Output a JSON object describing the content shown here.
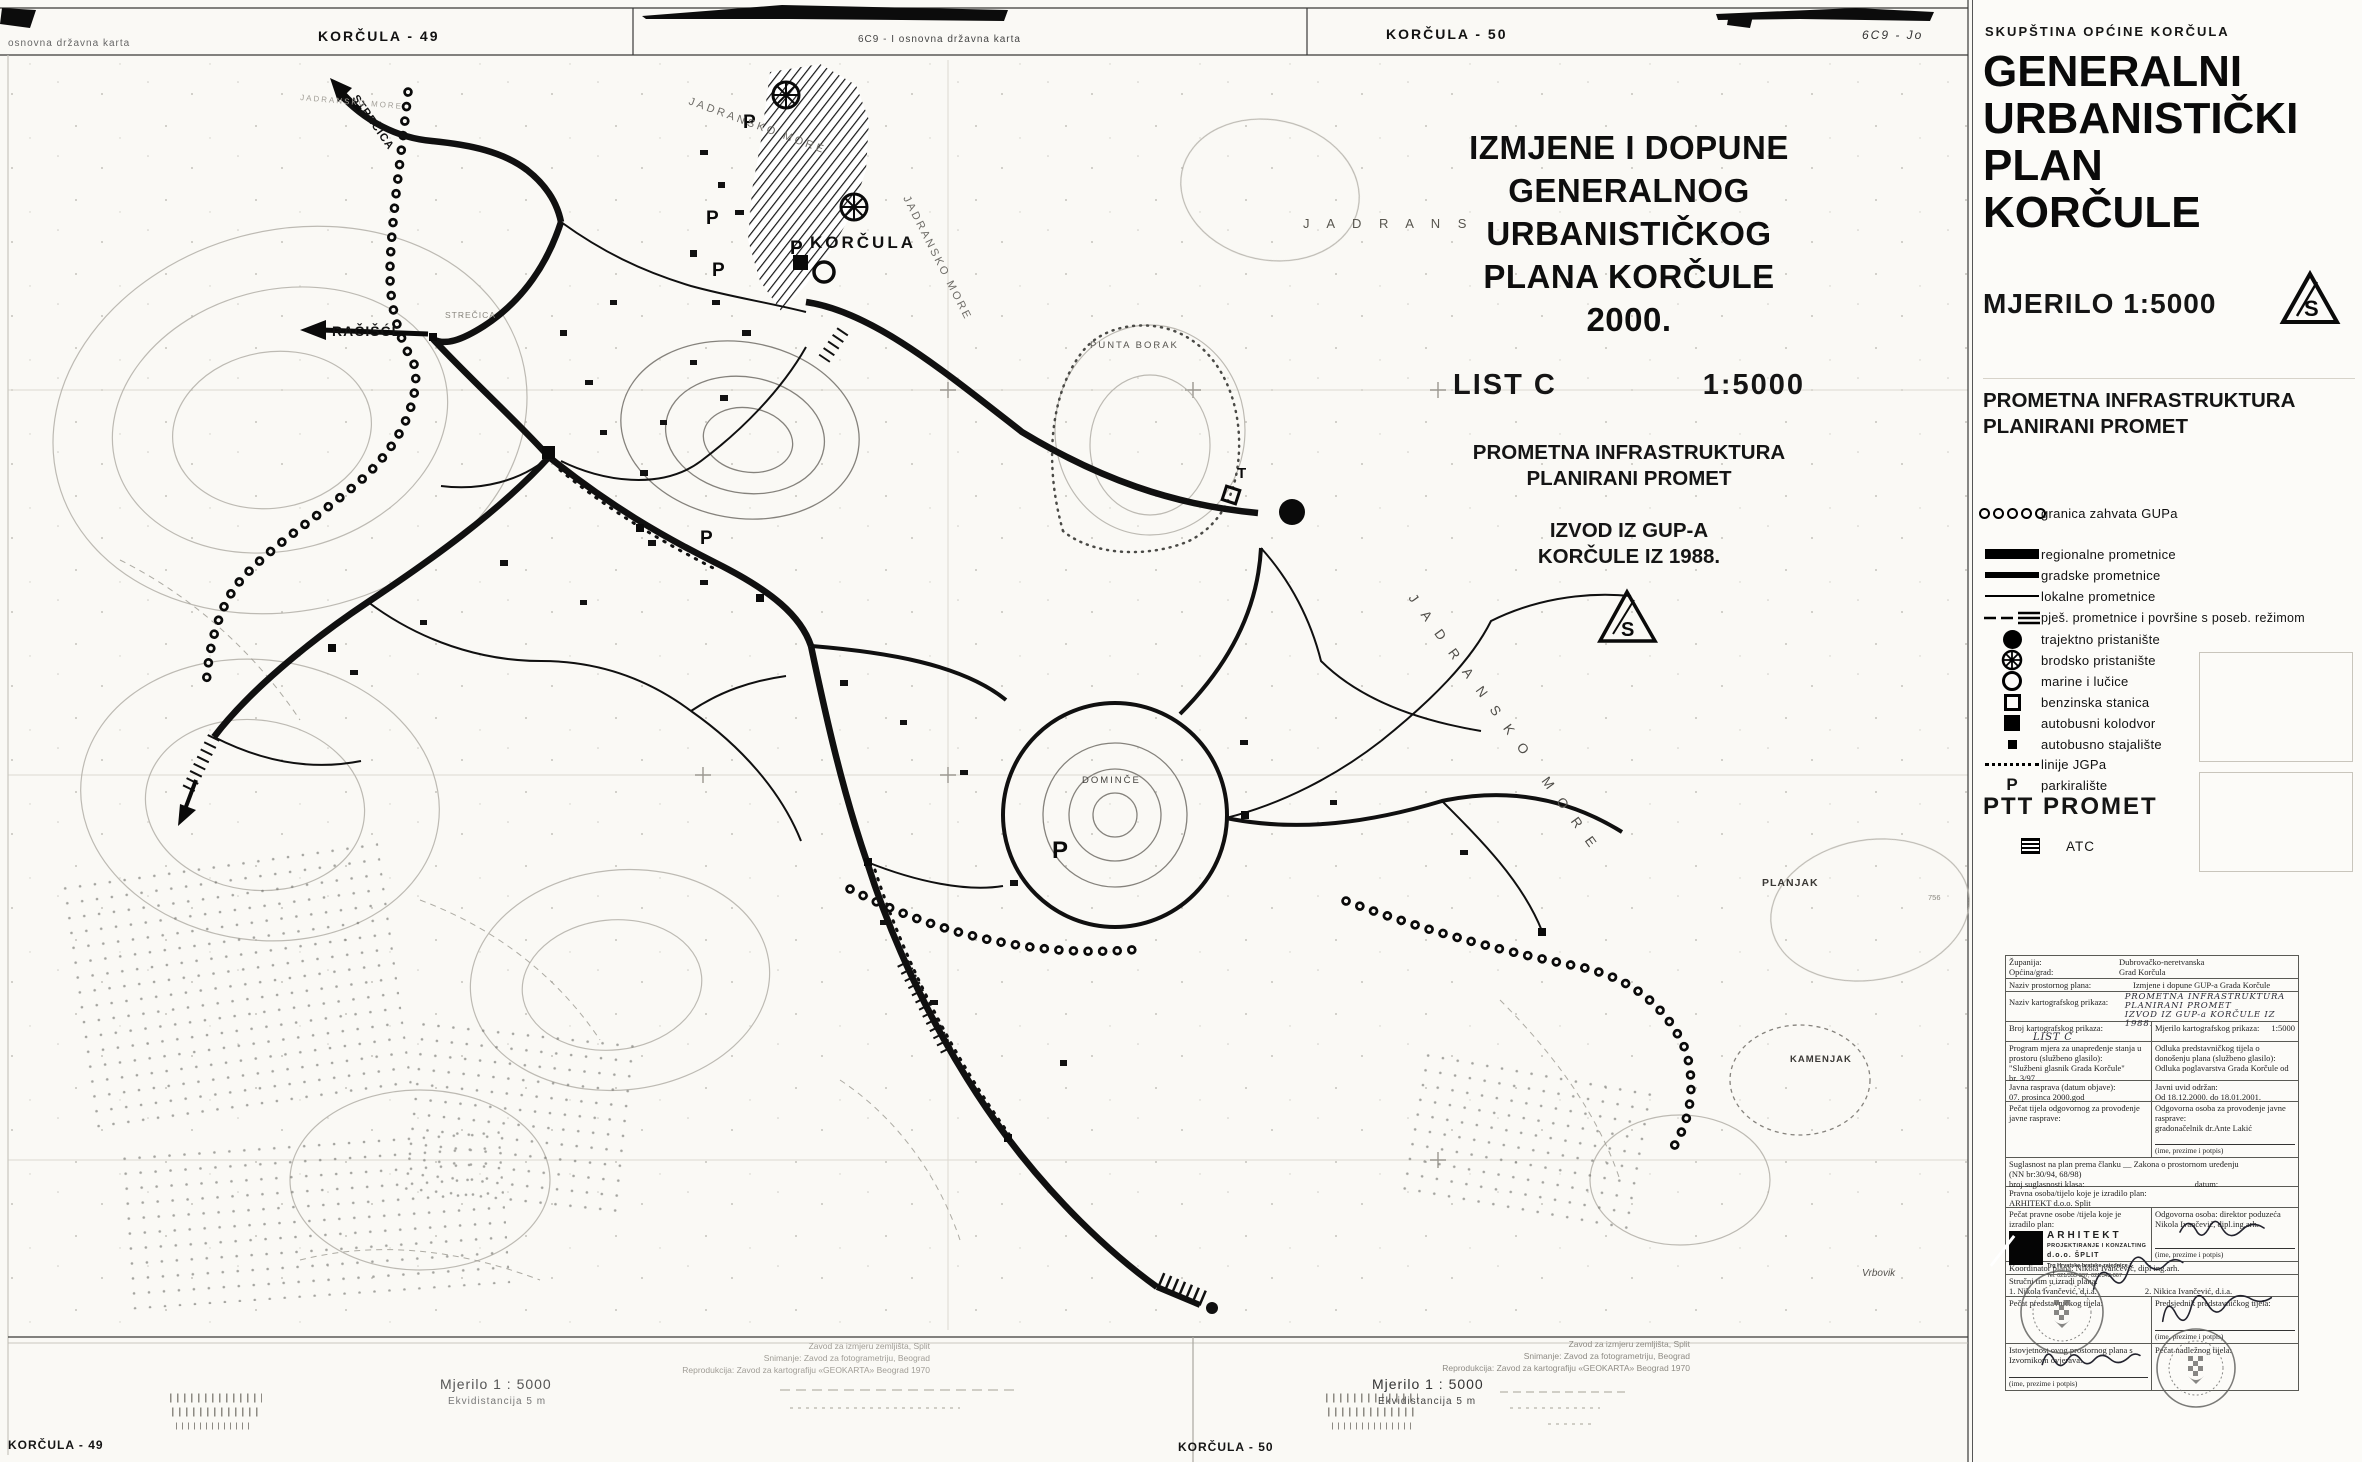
{
  "map_header": {
    "left_note": "osnovna državna karta",
    "sheet_49": "KORČULA - 49",
    "sheet_50": "KORČULA - 50",
    "code_center": "6C9 - I  osnovna državna karta",
    "code_right": "6C9 - Jo"
  },
  "title_block": {
    "lines": [
      "IZMJENE I DOPUNE",
      "GENERALNOG",
      "URBANISTIČKOG",
      "PLANA KORČULE",
      "2000."
    ],
    "list_label": "LIST  C",
    "scale": "1:5000",
    "sub1": "PROMETNA INFRASTRUKTURA",
    "sub2": "PLANIRANI PROMET",
    "sub3": "IZVOD IZ GUP-A",
    "sub4": "KORČULE IZ 1988."
  },
  "map_labels": {
    "town": "KORČULA",
    "punta_borak": "PUNTA BORAK",
    "domince": "DOMINČE",
    "planjak": "PLANJAK",
    "kamenjak": "KAMENJAK",
    "vrbovik": "Vrbovik",
    "racisce": "RAČIŠĆE",
    "strecica": "STREČICA",
    "strecica_area": "STREČICA",
    "sea": "JADRANSKO MORE",
    "sea_short": "J A D R A N S",
    "elev": "756",
    "parking": "P",
    "t_mark": "T"
  },
  "panel": {
    "org": "SKUPŠTINA OPĆINE KORČULA",
    "title1": "GENERALNI",
    "title2": "URBANISTIČKI",
    "title3": "PLAN",
    "title4": "KORČULE",
    "scale_label": "MJERILO  1:5000",
    "north_letter": "S",
    "section1": "PROMETNA INFRASTRUKTURA",
    "section2": "PLANIRANI PROMET",
    "legend": [
      {
        "symbol": "boundary-dots",
        "label": "granica zahvata GUPa"
      },
      {
        "symbol": "regional-road",
        "label": "regionalne prometnice"
      },
      {
        "symbol": "city-road",
        "label": "gradske prometnice"
      },
      {
        "symbol": "local-road",
        "label": "lokalne prometnice"
      },
      {
        "symbol": "pedestrian",
        "label": "pješ. prometnice i površine s poseb. režimom"
      },
      {
        "symbol": "ferry-port",
        "label": "trajektno pristanište"
      },
      {
        "symbol": "ship-port",
        "label": "brodsko pristanište"
      },
      {
        "symbol": "marina",
        "label": "marine i lučice"
      },
      {
        "symbol": "gas-station",
        "label": "benzinska stanica"
      },
      {
        "symbol": "bus-terminal",
        "label": "autobusni kolodvor"
      },
      {
        "symbol": "bus-stop",
        "label": "autobusno stajalište"
      },
      {
        "symbol": "jgp-lines",
        "label": "linije JGPa"
      },
      {
        "symbol": "parking",
        "label": "parkiralište"
      }
    ],
    "ptt": "PTT PROMET",
    "atc": "ATC"
  },
  "doc_table": {
    "r1a_label": "Županija:",
    "r1a_value": "Dubrovačko-neretvanska",
    "r1b_label": "Općina/grad:",
    "r1b_value": "Grad Korčula",
    "r2_label": "Naziv prostornog plana:",
    "r2_value": "Izmjene i dopune GUP-a Grada Korčule",
    "r3_label": "Naziv kartografskog prikaza:",
    "r3_hand1": "PROMETNA INFRASTRUKTURA",
    "r3_hand2": "PLANIRANI  PROMET",
    "r3_hand3": "IZVOD IZ GUP-a KORČULE IZ 1988.",
    "r4_left_label": "Broj kartografskog prikaza:",
    "r4_left_value": "LIST  C",
    "r4_right_label": "Mjerilo kartografskog prikaza:",
    "r4_right_value": "1:5000",
    "r5_left1": "Program mjera za unapređenje stanja u prostoru (službeno glasilo):",
    "r5_left2": "\"Službeni glasnik Grada Korčule\"",
    "r5_left3": "br. 3/97",
    "r5_right1": "Odluka predstavničkog tijela o donošenju plana (službeno glasilo):",
    "r5_right2": "Odluka poglavarstva Grada Korčule od",
    "r6_left_label": "Javna rasprava (datum objave):",
    "r6_left_value": "07. prosinca 2000.god",
    "r6_right_label": "Javni uvid održan:",
    "r6_right_value": "Od 18.12.2000. do 18.01.2001.",
    "r7_left": "Pečat tijela odgovornog za provođenje javne rasprave:",
    "r7_right1": "Odgovorna osoba za provođenje javne rasprave:",
    "r7_right2": "gradonačelnik dr.Ante Lakić",
    "r7_caption": "(ime, prezime i potpis)",
    "r8_line1": "Suglasnost na plan prema članku __ Zakona o prostornom uređenju",
    "r8_line2": "(NN br:30/94, 68/98)",
    "r8_line3a": "broj suglasnosti klasa:",
    "r8_line3b": "datum:",
    "r9_label": "Pravna osoba/tijelo koje je izradilo plan:",
    "r9_value": "ARHITEKT d.o.o. Split",
    "r10_left": "Pečat pravne osobe /tijela koje je izradilo plan:",
    "logo_name": "ARHITEKT",
    "logo_line2": "PROJEKTIRANJE I KONZALTING",
    "logo_line3": "d.o.o. ŠPLIT",
    "logo_line4": "Trg Hrvatske bratske zajednice 1",
    "logo_line5": "Tel: 021/355-337, 021/342-067",
    "r10_right1": "Odgovorna osoba: direktor poduzeća",
    "r10_right2": "Nikola Ivančević, dipl.ing.arh.",
    "r10_caption": "(ime, prezime i potpis)",
    "r11": "Koordinator plana: Nikola Ivančević, dipl ing.arh.",
    "r12_label": "Stručni tim u izradi plana:",
    "r12_m1": "1. Nikola Ivančević, d.i.a.",
    "r12_m2": "2. Nikica Ivančević, d.i.a.",
    "r13_left": "Pečat predstavničkog tijela:",
    "r13_right": "Predsjednik predstavničkog tijela:",
    "r13_caption": "(ime, prezime i potpis)",
    "r14_left1": "Istovjetnost ovog prostornog plana s",
    "r14_left2": "Izvornikom ovjerava:",
    "r14_caption": "(ime, prezime i potpis)",
    "r14_right": "Pečat nadležnog tijela:"
  },
  "footer": {
    "mjerilo": "Mjerilo 1 : 5000",
    "ekvidistanca": "Ekvidistancija 5 m",
    "credit1": "Zavod za izmjeru zemljišta, Split",
    "credit2": "Snimanje: Zavod za fotogrametriju, Beograd",
    "credit3": "Reprodukcija: Zavod za kartografiju «GEOKARTA» Beograd 1970",
    "sheet_49": "KORČULA - 49",
    "sheet_50": "KORČULA - 50"
  }
}
